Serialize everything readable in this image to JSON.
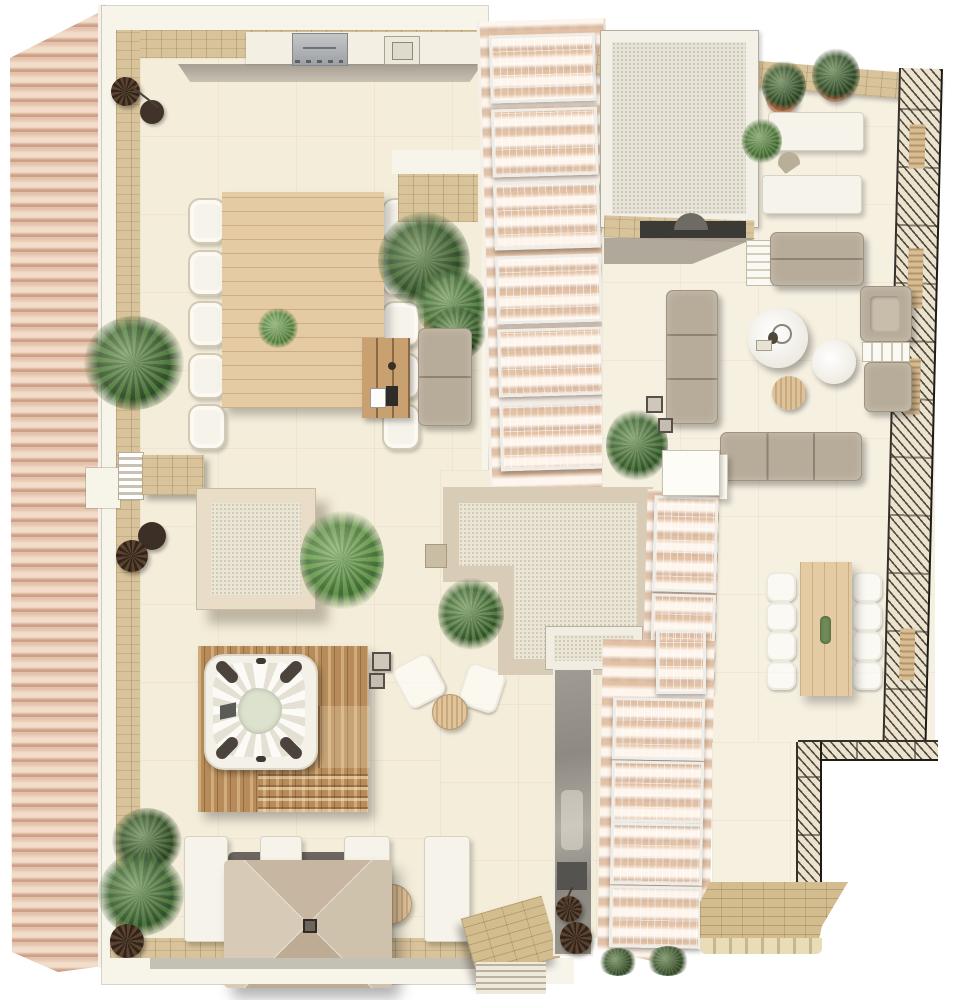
{
  "scene": {
    "title": "Rooftop terrace architectural plan — top view 3D render",
    "areas": [
      {
        "name": "left-terrace",
        "description": "large cream-tiled terrace with outdoor kitchen, 10-seat dining table, hot tub on wood deck, sun loungers and square parasol"
      },
      {
        "name": "right-terrace",
        "description": "cream-tiled lounge terrace with modular sofas, round coffee tables, daybed, sun loungers and 8-seat dining table"
      },
      {
        "name": "tiled-roof-left",
        "description": "barrel-tile pitched roof strip"
      },
      {
        "name": "solar-roof-center",
        "description": "tiled roof strip with photovoltaic panel array"
      },
      {
        "name": "solar-roof-bottom",
        "description": "tiled roof strip with photovoltaic panel array and roof window"
      },
      {
        "name": "lower-landing",
        "description": "stone-paved landing with ramp, steps and railing"
      }
    ],
    "objects": [
      "outdoor-kitchen-grill",
      "outdoor-kitchen-sink",
      "dining-table-10",
      "dining-table-8",
      "picnic-table",
      "loveseat",
      "hot-tub",
      "wood-deck",
      "square-parasol",
      "sun-loungers",
      "modular-sofas",
      "armchair-with-ottoman",
      "daybed",
      "round-coffee-tables",
      "skylights",
      "potted-cypresses",
      "palms-and-plants",
      "glass-balustrade",
      "solar-panels",
      "stairwell-opening",
      "stone-ramp-steps"
    ]
  },
  "palette": {
    "paper": "#ffffff",
    "floor": "#f4edda",
    "floor2": "#f6f0e1",
    "wall_white": "#f7f4ea",
    "stone": "#d8c39a",
    "paving": "#d3bd8f",
    "roof_tile": "#e3c2ab",
    "roof_tile_hi": "#f2ddca",
    "roof_tile_lo": "#cda087",
    "panel": "#8f8e97",
    "panel_frame": "#efede8",
    "wood_table": "#e4cba4",
    "wood_deck": "#b78c5a",
    "taupe": "#b7ab99",
    "white_furn": "#f6f3ea",
    "plant_dark": "#2f4d2b",
    "plant_mid": "#49703a",
    "plant_light": "#66924d",
    "terracotta": "#a85a36",
    "glass": "#8f8c85"
  },
  "solar": {
    "arrays": {
      "top": {
        "count": 6,
        "panel_w": 100,
        "panel_h": 62
      },
      "mid": {
        "count": 2,
        "panel_w": 58,
        "panel_h": 90
      },
      "bottom": {
        "count": 4,
        "panel_w": 86,
        "panel_h": 56
      }
    },
    "partial_panel_count": 1
  },
  "furniture": {
    "left_dining": {
      "chairs_per_side": 5
    },
    "right_dining": {
      "chairs_per_side": 4
    },
    "bottom_loungers": {
      "count": 4
    },
    "top_right_loungers": {
      "count": 2
    },
    "sofa_seats_vertical": 3,
    "sofa_seats_horizontal": 3
  }
}
